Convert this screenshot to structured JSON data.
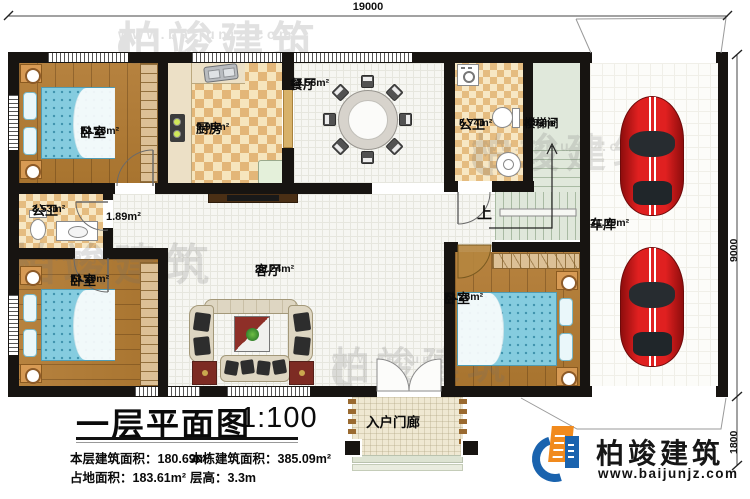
{
  "dimensions": {
    "top": "19000",
    "right_upper": "9000",
    "right_lower": "1800"
  },
  "rooms": {
    "bedroom_top_left": {
      "name": "卧室",
      "area": "12.26m²"
    },
    "kitchen": {
      "name": "厨房",
      "area": "9.98m²"
    },
    "dining": {
      "name": "餐厅",
      "area": "13.56m²"
    },
    "bathroom_top": {
      "name": "公卫",
      "area": "5.74m²"
    },
    "stairwell": {
      "name": "楼梯间",
      "area": "8.82m²"
    },
    "garage": {
      "name": "车库",
      "area": "31.19m²"
    },
    "bathroom_left": {
      "name": "公卫",
      "area": "3.53m²"
    },
    "hallway": {
      "area": "1.89m²"
    },
    "bedroom_bottom_left": {
      "name": "卧室",
      "area": "13.39m²"
    },
    "living": {
      "name": "客厅",
      "area": "39.24m²"
    },
    "bedroom_bottom_center": {
      "name": "卧室",
      "area": "12.26m²"
    },
    "porch": {
      "name": "入户门廊"
    },
    "stairs_direction": "上"
  },
  "title_block": {
    "title": "一层平面图",
    "scale": "1:100",
    "stats": [
      {
        "label": "本层建筑面积：",
        "value": "180.69m²"
      },
      {
        "label": "本栋建筑面积：",
        "value": "385.09m²"
      },
      {
        "label": "占地面积：",
        "value": "183.61m²"
      },
      {
        "label": "层高：",
        "value": "3.3m"
      }
    ]
  },
  "brand": {
    "name": "柏竣建筑",
    "website": "www.baijunjz.com"
  },
  "watermark": {
    "text": "柏竣建筑",
    "subtext": "www.baijunjz.com"
  }
}
